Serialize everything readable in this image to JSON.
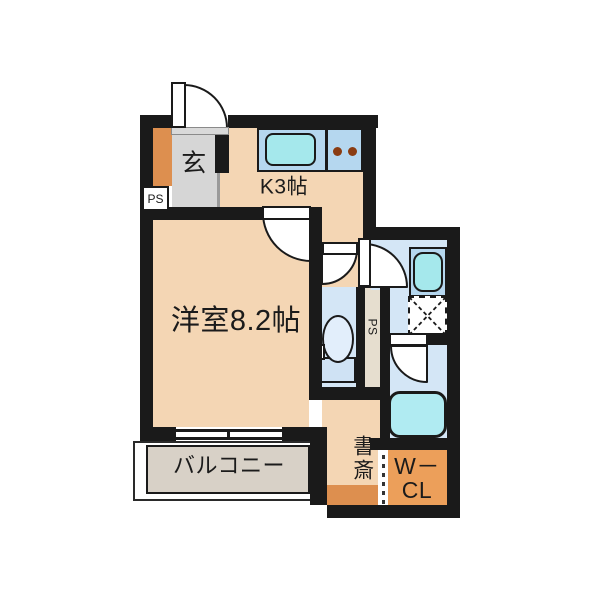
{
  "title": "apartment-floor-plan",
  "labels": {
    "genkan": "玄",
    "kitchen": "K3帖",
    "main_room": "洋室8.2帖",
    "balcony": "バルコニー",
    "study": "書斎",
    "closet_line1": "W－",
    "closet_line2": "CL",
    "ps_entrance": "PS",
    "ps_side": "PS"
  },
  "colors": {
    "wall": "#1a1a1a",
    "room_peach": "#f4d6b4",
    "entry_gray": "#d6d6d6",
    "storage_orange": "#dd8f4f",
    "closet_orange": "#ec9f5a",
    "wet_blue": "#d4e6f6",
    "counter_blue": "#b5d7ef",
    "fixture_cyan": "#a5e8ec",
    "tub_cyan": "#b0ebf2",
    "balcony_gray": "#d8d1c7",
    "ps_beige": "#e6decf",
    "text": "#1b1b1b"
  }
}
